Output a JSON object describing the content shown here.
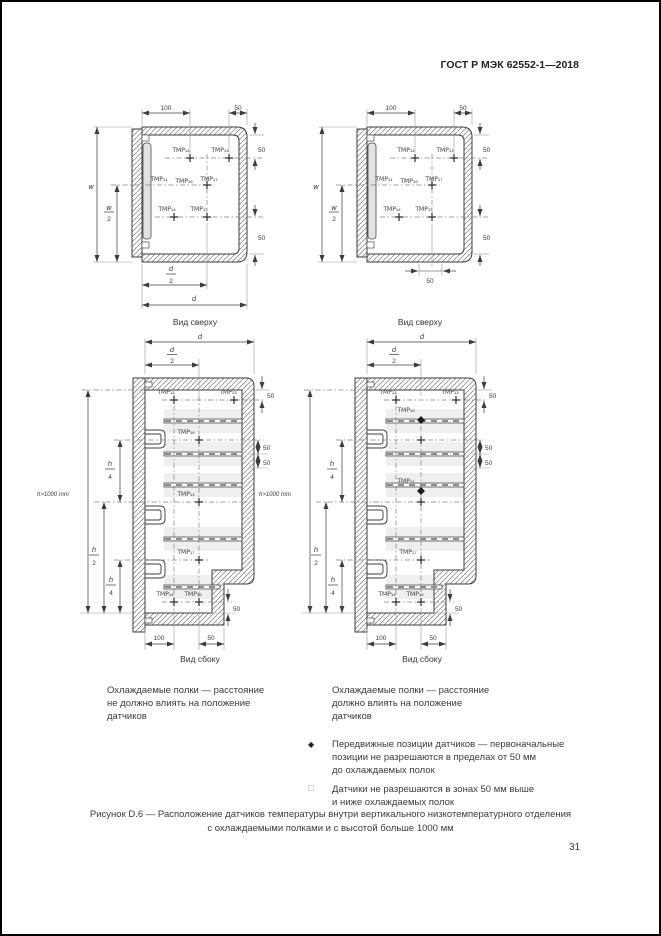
{
  "header": {
    "standard_ref": "ГОСТ Р МЭК 62552-1—2018"
  },
  "captions": {
    "top_view": "Вид сверху",
    "side_view": "Вид сбоку"
  },
  "sensors": {
    "tmp11": "TMP₁₁",
    "tmp12": "TMP₁₂",
    "tmp13": "TMP₁₃",
    "tmp14": "TMP₁₄",
    "tmp15": "TMP₁₅",
    "tmp16": "TMP₁₆",
    "tmp17": "TMP₁₇"
  },
  "dims": {
    "v100": "100",
    "v50": "50",
    "w": "w",
    "d": "d",
    "h": "h",
    "two": "2",
    "four": "4",
    "h_total": "h>1000 mm"
  },
  "notes": {
    "left_lines": [
      "Охлаждаемые полки — расстояние",
      "не должно влиять на положение",
      "датчиков"
    ],
    "right_lines": [
      "Охлаждаемые полки — расстояние",
      "должно влиять на положение",
      "датчиков"
    ],
    "diamond_bullet": "◆",
    "diamond_lines": [
      "Передвижные позиции датчиков — первоначальные",
      "позиции не разрешаются в пределах от 50 мм",
      "до охлаждаемых полок"
    ],
    "square_bullet": "□",
    "square_lines": [
      "Датчики не разрешаются в зонах 50 мм выше",
      "и ниже охлаждаемых полок"
    ]
  },
  "figure": {
    "caption_lines": [
      "Рисунок D.6 — Расположение датчиков температуры внутри вертикального низкотемпературного отделения",
      "с охлаждаемыми полками и с высотой больше 1000 мм"
    ]
  },
  "page": {
    "number": "31"
  }
}
